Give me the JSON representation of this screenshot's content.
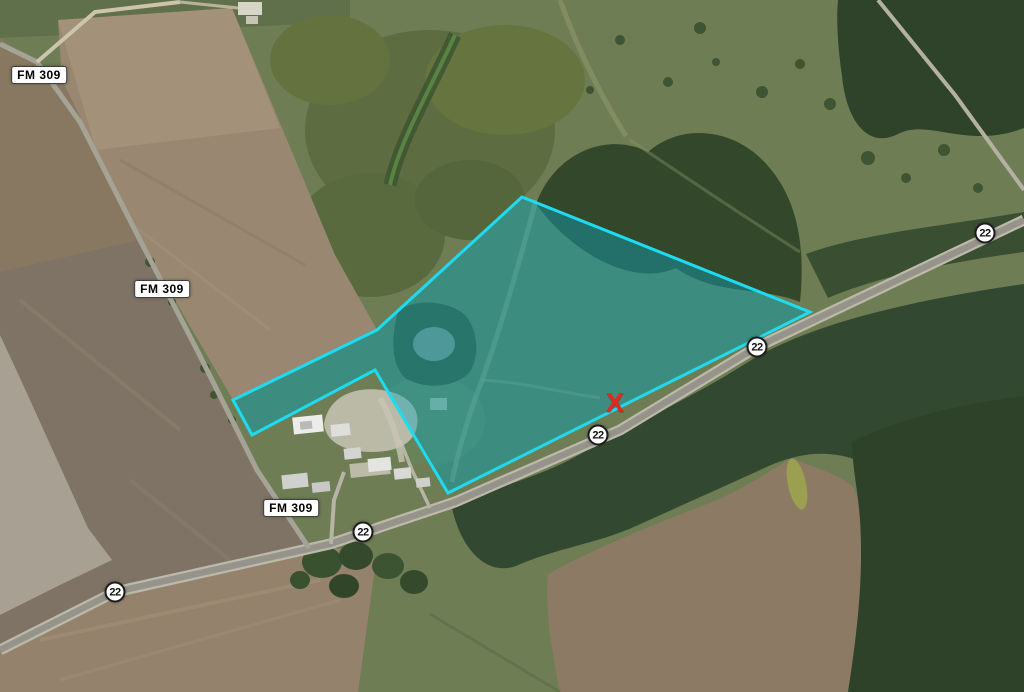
{
  "map": {
    "description": "Aerial satellite view of rural land parcel for sale along State Highway 22 and FM 309",
    "parcel": {
      "points": "522,197 810,312 448,493 375,370 252,435 233,400 377,330",
      "stroke_color": "#1ddcf2",
      "fill_color": "rgba(14,168,190,0.42)"
    },
    "marker_x": {
      "text": "X",
      "x": 615,
      "y": 404,
      "color": "#e8261c"
    },
    "highway_shields": [
      {
        "label": "22",
        "x": 985,
        "y": 233
      },
      {
        "label": "22",
        "x": 757,
        "y": 347
      },
      {
        "label": "22",
        "x": 598,
        "y": 435
      },
      {
        "label": "22",
        "x": 363,
        "y": 532
      },
      {
        "label": "22",
        "x": 115,
        "y": 592
      }
    ],
    "road_labels": [
      {
        "label": "FM 309",
        "x": 39,
        "y": 75
      },
      {
        "label": "FM 309",
        "x": 162,
        "y": 289
      },
      {
        "label": "FM 309",
        "x": 291,
        "y": 508
      }
    ]
  }
}
